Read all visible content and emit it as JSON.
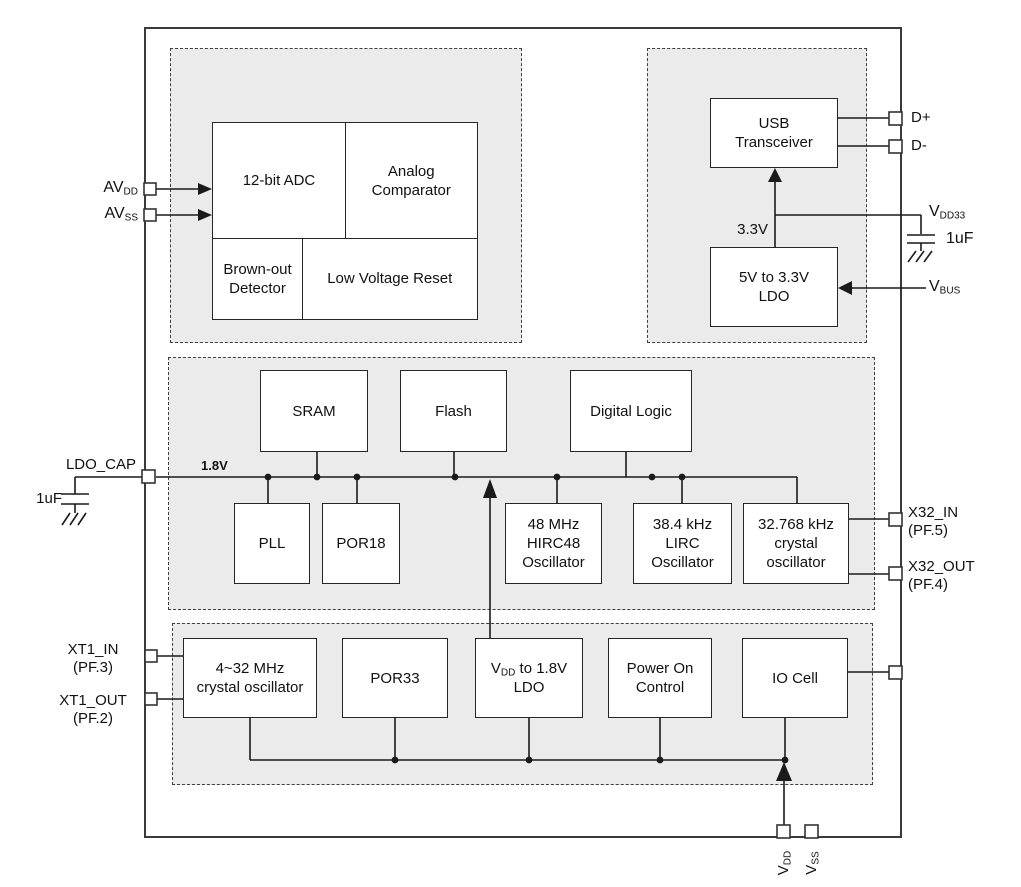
{
  "blocks": {
    "adc": {
      "label": "12-bit ADC"
    },
    "comparator": {
      "line1": "Analog",
      "line2": "Comparator"
    },
    "brownout": {
      "line1": "Brown-out",
      "line2": "Detector"
    },
    "lvr": {
      "label": "Low Voltage Reset"
    },
    "usb": {
      "line1": "USB",
      "line2": "Transceiver"
    },
    "ldo5": {
      "line1": "5V to 3.3V",
      "line2": "LDO"
    },
    "sram": {
      "label": "SRAM"
    },
    "flash": {
      "label": "Flash"
    },
    "digital": {
      "label": "Digital Logic"
    },
    "pll": {
      "label": "PLL"
    },
    "por18": {
      "label": "POR18"
    },
    "hirc48": {
      "line1": "48 MHz",
      "line2": "HIRC48",
      "line3": "Oscillator"
    },
    "lirc": {
      "line1": "38.4 kHz",
      "line2": "LIRC",
      "line3": "Oscillator"
    },
    "xtal32": {
      "line1": "32.768 kHz",
      "line2": "crystal",
      "line3": "oscillator"
    },
    "xtalhf": {
      "line1": "4~32 MHz",
      "line2": "crystal oscillator"
    },
    "por33": {
      "label": "POR33"
    },
    "ldo18": {
      "pre": "V",
      "sub": "DD",
      "post": " to 1.8V",
      "line2": "LDO"
    },
    "poc": {
      "line1": "Power On",
      "line2": "Control"
    },
    "iocell": {
      "label": "IO Cell"
    }
  },
  "pins": {
    "avdd": {
      "main": "AV",
      "sub": "DD"
    },
    "avss": {
      "main": "AV",
      "sub": "SS"
    },
    "ldo_cap": {
      "label": "LDO_CAP"
    },
    "cap_left": {
      "label": "1uF"
    },
    "xt1_in": {
      "line1": "XT1_IN",
      "line2": "(PF.3)"
    },
    "xt1_out": {
      "line1": "XT1_OUT",
      "line2": "(PF.2)"
    },
    "dplus": {
      "label": "D+"
    },
    "dminus": {
      "label": "D-"
    },
    "vdd33": {
      "main": "V",
      "sub": "DD33"
    },
    "cap_right": {
      "label": "1uF"
    },
    "vbus": {
      "main": "V",
      "sub": "BUS"
    },
    "x32_in": {
      "line1": "X32_IN",
      "line2": "(PF.5)"
    },
    "x32_out": {
      "line1": "X32_OUT",
      "line2": "(PF.4)"
    },
    "vdd": {
      "main": "V",
      "sub": "DD"
    },
    "vss": {
      "main": "V",
      "sub": "SS"
    }
  },
  "nets": {
    "v18": "1.8V",
    "v33": "3.3V"
  },
  "colors": {
    "background": "#ffffff",
    "region_fill": "#ebebeb",
    "region_border": "#3f3f3f",
    "chip_border": "#3a3a3a",
    "block_border": "#262626",
    "wire": "#1a1a1a",
    "text": "#111111"
  }
}
